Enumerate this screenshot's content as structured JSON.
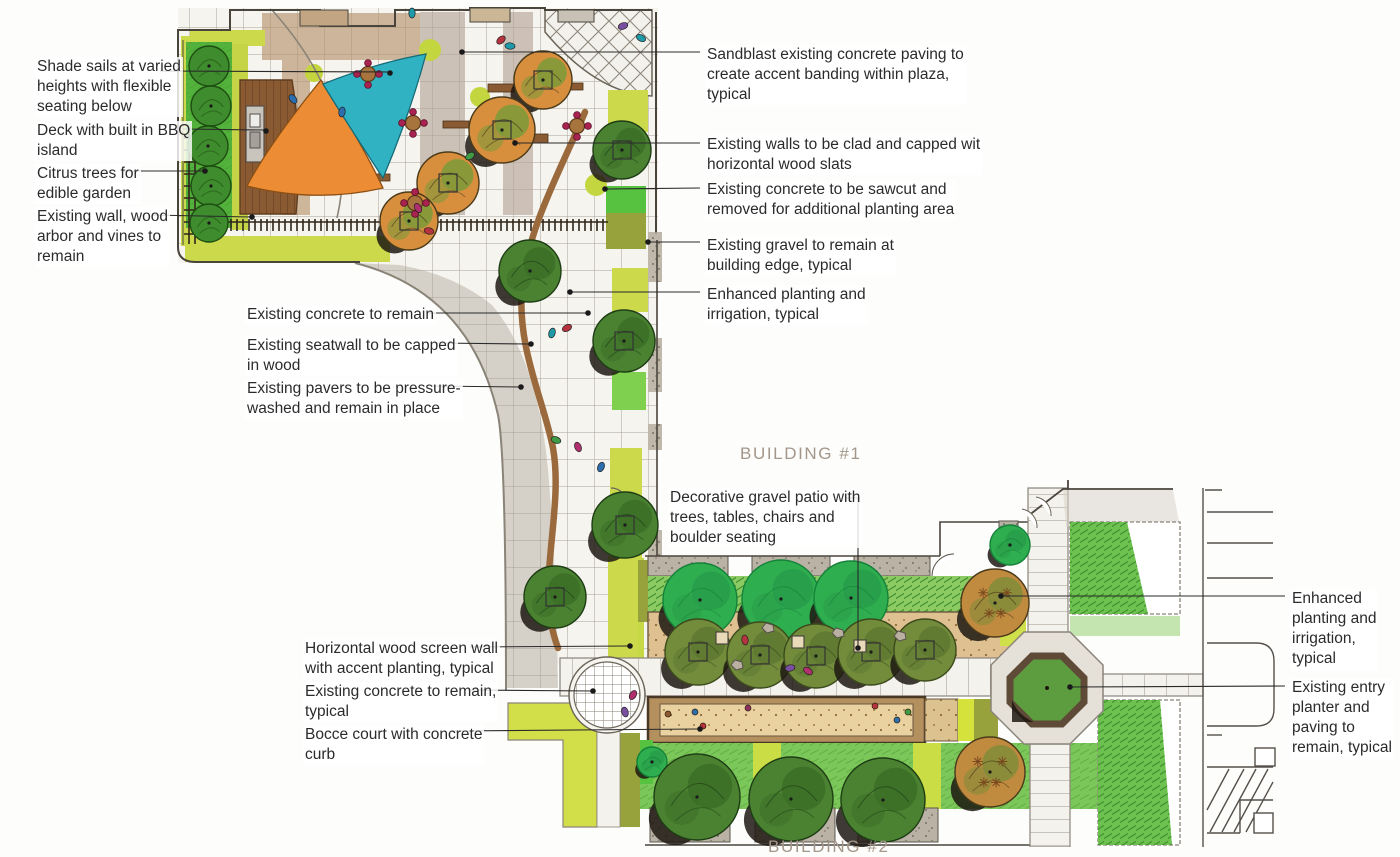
{
  "drawing": {
    "type": "landscape-architecture-site-plan",
    "building_labels": {
      "building_1": "BUILDING #1",
      "building_2": "BUILDING #2"
    },
    "colors": {
      "shade_sail_teal": "#31b2c2",
      "shade_sail_orange": "#ec8c34",
      "lawn_green": "#52b23b",
      "planting_yellow_green": "#cbd94a",
      "tree_dark_green": "#4a8232",
      "tree_emerald": "#2fae4f",
      "tree_olive": "#728c3c",
      "tree_orange": "#d78f3e",
      "deck_wood": "#8a5a33",
      "seatwall_wood": "#9a6a3d",
      "paving_gray": "#d6d1c8",
      "bocce_tan": "#ead2a0",
      "gravel_gray": "#b5ada1"
    }
  },
  "annotations": {
    "left": [
      {
        "id": "shade-sails",
        "text": "Shade sails at varied\nheights with flexible\nseating below"
      },
      {
        "id": "deck-bbq",
        "text": "Deck with built in BBQ\nisland"
      },
      {
        "id": "citrus-trees",
        "text": "Citrus trees for\nedible garden"
      },
      {
        "id": "existing-wall-arbor",
        "text": "Existing wall, wood\narbor and vines to\nremain"
      },
      {
        "id": "existing-concrete",
        "text": "Existing concrete to remain"
      },
      {
        "id": "existing-seatwall",
        "text": "Existing seatwall to be capped\nin wood"
      },
      {
        "id": "existing-pavers",
        "text": "Existing pavers to be pressure-\nwashed and remain in place"
      },
      {
        "id": "wood-screen-wall",
        "text": "Horizontal wood screen wall\nwith accent planting, typical"
      },
      {
        "id": "existing-concrete-typical",
        "text": "Existing concrete to remain,\ntypical"
      },
      {
        "id": "bocce-court",
        "text": "Bocce court with concrete\ncurb"
      }
    ],
    "right": [
      {
        "id": "sandblast",
        "text": "Sandblast existing concrete paving to\ncreate accent banding within plaza,\ntypical"
      },
      {
        "id": "walls-clad",
        "text": "Existing walls to be clad and capped wit\nhorizontal wood slats"
      },
      {
        "id": "sawcut",
        "text": "Existing concrete to be sawcut and\nremoved for additional planting area"
      },
      {
        "id": "gravel-edge",
        "text": "Existing gravel to remain at\nbuilding edge, typical"
      },
      {
        "id": "enhanced-planting-1",
        "text": "Enhanced planting and\nirrigation, typical"
      },
      {
        "id": "decorative-gravel",
        "text": "Decorative gravel patio with\ntrees, tables, chairs and\nboulder seating"
      },
      {
        "id": "enhanced-planting-2",
        "text": "Enhanced\nplanting and\nirrigation,\ntypical"
      },
      {
        "id": "entry-planter",
        "text": "Existing entry\nplanter and\npaving to\nremain, typical"
      }
    ]
  }
}
